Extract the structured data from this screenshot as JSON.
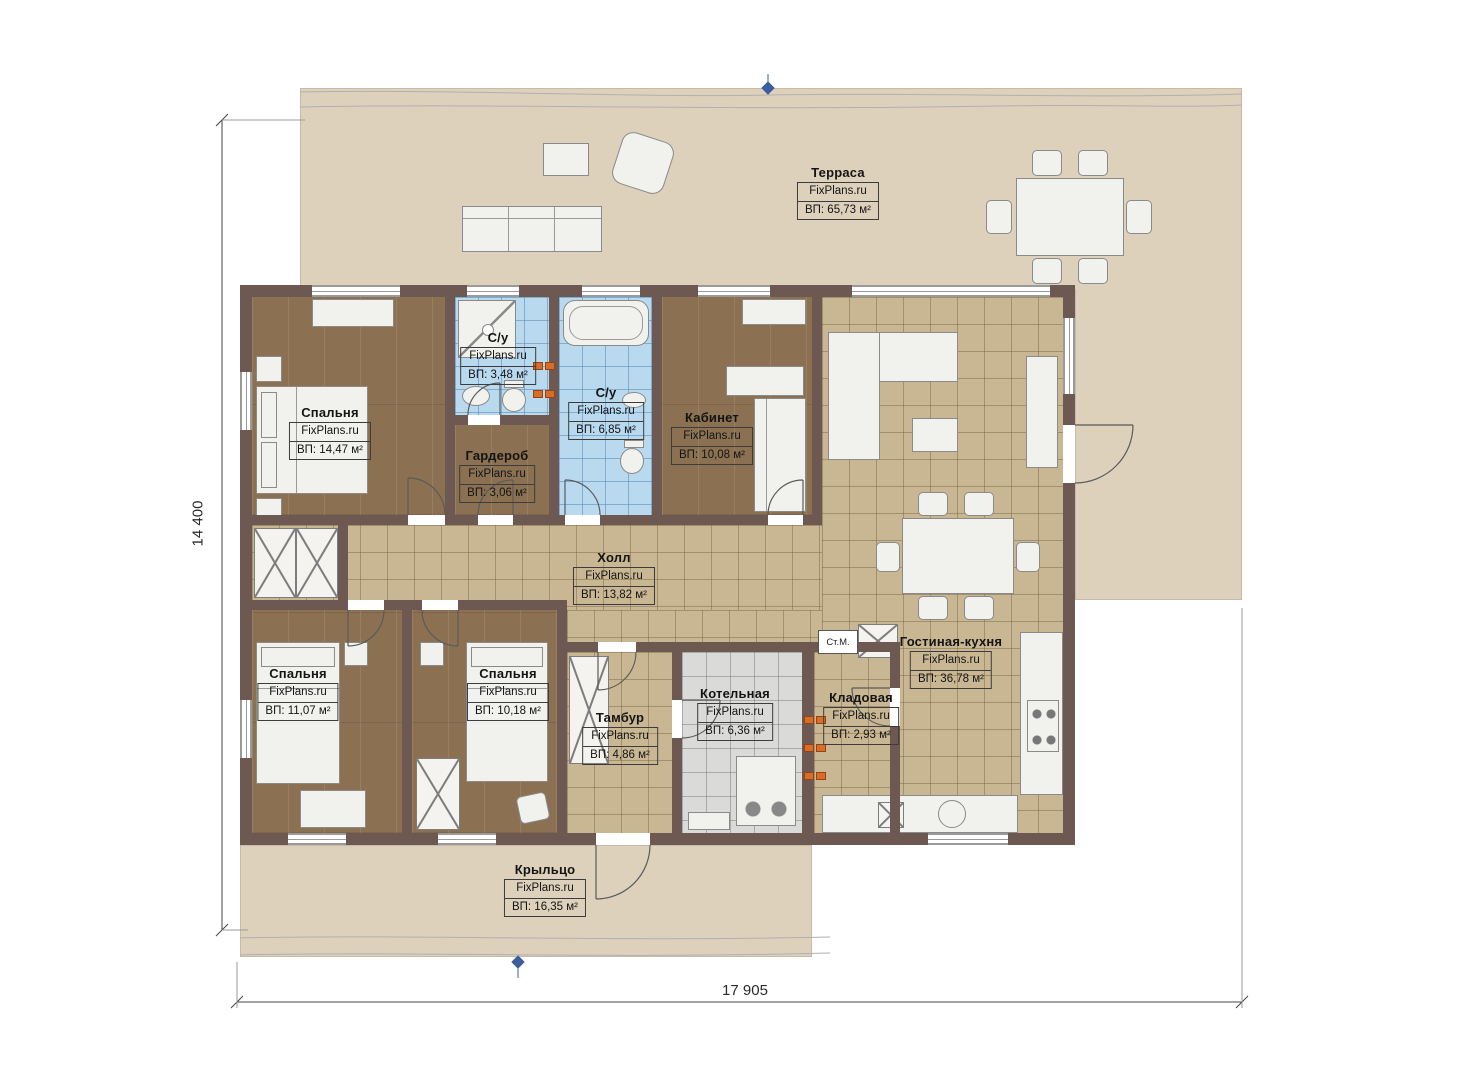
{
  "watermark": "FixPlans.ru",
  "dimensions": {
    "height_mm": "14 400",
    "width_mm": "17 905"
  },
  "rooms": [
    {
      "id": "terrace",
      "name": "Терраса",
      "area": "ВП: 65,73 м²"
    },
    {
      "id": "bedroom-1",
      "name": "Спальня",
      "area": "ВП: 14,47 м²"
    },
    {
      "id": "bathroom-1",
      "name": "С/у",
      "area": "ВП: 3,48 м²"
    },
    {
      "id": "bathroom-2",
      "name": "С/у",
      "area": "ВП: 6,85 м²"
    },
    {
      "id": "office",
      "name": "Кабинет",
      "area": "ВП: 10,08 м²"
    },
    {
      "id": "wardrobe-room",
      "name": "Гардероб",
      "area": "ВП: 3,06 м²"
    },
    {
      "id": "hall",
      "name": "Холл",
      "area": "ВП: 13,82 м²"
    },
    {
      "id": "bedroom-2",
      "name": "Спальня",
      "area": "ВП: 11,07 м²"
    },
    {
      "id": "bedroom-3",
      "name": "Спальня",
      "area": "ВП: 10,18 м²"
    },
    {
      "id": "vestibule",
      "name": "Тамбур",
      "area": "ВП: 4,86 м²"
    },
    {
      "id": "boiler-room",
      "name": "Котельная",
      "area": "ВП: 6,36 м²"
    },
    {
      "id": "storage",
      "name": "Кладовая",
      "area": "ВП: 2,93 м²"
    },
    {
      "id": "living-kitchen",
      "name": "Гостиная-кухня",
      "area": "ВП: 36,78 м²"
    },
    {
      "id": "porch",
      "name": "Крыльцо",
      "area": "ВП: 16,35 м²"
    }
  ],
  "annotations": {
    "washing_machine": "Ст.М."
  },
  "colors": {
    "wall": "#6e5952",
    "terrace": "#ddd1bc",
    "wood_floor": "#8b7152",
    "tile_tan": "#c9b793",
    "tile_blue": "#b9d9ef",
    "tile_gray": "#dadad8",
    "furniture": "#f1f1ee",
    "socket_accent": "#d96c28",
    "marker_blue": "#3c5e9d"
  }
}
